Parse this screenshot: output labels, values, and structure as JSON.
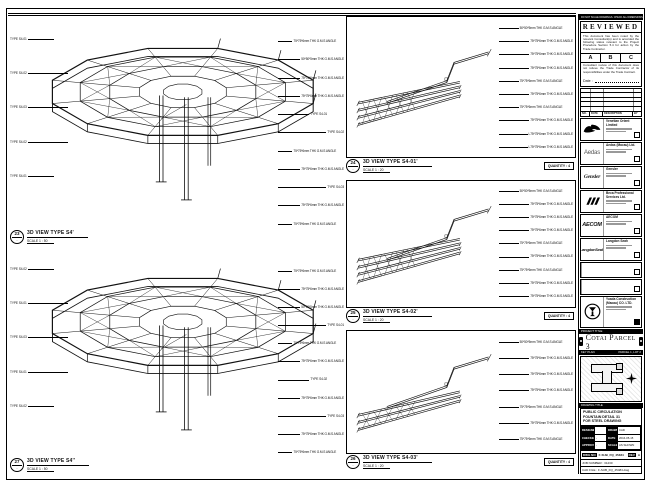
{
  "sheet_note": "DO NOT SCALE DRAWINGS. CHECK ALL DIMENSIONS ON SITE.",
  "reviewed": {
    "title": "REVIEWED",
    "body1": "This document has been noted by the relevant Consultant(s) and is accorded the following status relevant to the Project Procedure Section 5.4 for action by the Trade Contractor.",
    "options": {
      "a": "A",
      "b": "B",
      "c": "C"
    },
    "body2": "Consultant review of this document does not relieve the Trade Contractor of its responsibilities under the Trade Contract.",
    "date_label": "Date :"
  },
  "rev_table": {
    "h1": "NO.",
    "h2": "DATE",
    "h3": "DESCRIPTION",
    "h4": "BY"
  },
  "companies": [
    {
      "wordmark": "",
      "name": "Venetian Orient Limited"
    },
    {
      "wordmark": "Aedas",
      "name": "Aedas (Macau) Ltd."
    },
    {
      "wordmark": "Gensler",
      "name": "Gensler"
    },
    {
      "wordmark": "",
      "name": "Beca Professional Services Ltd."
    },
    {
      "wordmark": "AECOM",
      "name": "AECOM"
    },
    {
      "wordmark": "LangdonSeah",
      "name": "Langdon Seah"
    }
  ],
  "contractor": {
    "name": "Yuada Construction",
    "name2": "(Macau) CO. LTD."
  },
  "project": {
    "label": "PROJECT TITLE",
    "name": "Cotai Parcel 3"
  },
  "keyplan": {
    "label": "KEY PLAN",
    "parcel": "PARCEL 1, LOT 2"
  },
  "drawing": {
    "label": "DRAWING TITLE",
    "line1": "PUBLIC CIRCULATION",
    "line2": "FOUNTAIN DETAIL 31",
    "line3": "FOR STEEL DRAWING",
    "designed_label": "DESIGNED",
    "designed": "",
    "drawn_label": "DRAWN",
    "drawn": "CAD",
    "checked_label": "CHECKED",
    "checked": "-",
    "date_label": "DATE",
    "date": "2016-05-15",
    "approved_label": "APPROVED",
    "approved": "-",
    "scale_label": "SCALE",
    "scale": "AS SHOWN",
    "dwg_label": "DWG NO",
    "dwg_no": "F-SUB_FQ_45484",
    "rev_label": "REV",
    "rev": "A",
    "job_row": "JOB NUMBER : 31230",
    "file_row": "CAD FILE : F-SUB_FQ_45484.dwg"
  },
  "views": {
    "l1": {
      "no": "23",
      "ref": "-",
      "title": "3D VIEW TYPE S4'",
      "scale": "SCALE 1 : 50",
      "labels_left": [
        "TYPE S4-01",
        "TYPE S4-02",
        "TYPE S4-03",
        "TYPE S4-02",
        "TYPE S4-01"
      ],
      "labels_right": [
        "75*75*6mm THK G.M.S ANGLE",
        "50*50*5mm THK G.M.S ANGLE",
        "75*75*6mm THK G.M.S ANGLE",
        "75*75*6mm THK G.M.S ANGLE",
        "TYPE S4-01",
        "TYPE S4-02",
        "75*75*6mm THK G.M.S ANGLE",
        "75*75*6mm THK G.M.S ANGLE",
        "TYPE S4-03",
        "75*75*6mm THK G.M.S ANGLE",
        "75*75*6mm THK G.M.S ANGLE"
      ]
    },
    "l2": {
      "no": "27",
      "ref": "-",
      "title": "3D VIEW TYPE S4''",
      "scale": "SCALE 1 : 50",
      "labels_left": [
        "TYPE S4-02",
        "TYPE S4-01",
        "TYPE S4-03",
        "TYPE S4-01",
        "TYPE S4-02"
      ],
      "labels_right": [
        "75*75*6mm THK G.M.S ANGLE",
        "75*75*6mm THK G.M.S ANGLE",
        "50*50*5mm THK G.M.S ANGLE",
        "TYPE S4-01",
        "75*75*6mm THK G.M.S ANGLE",
        "75*75*6mm THK G.M.S ANGLE",
        "TYPE S4-02",
        "75*75*6mm THK G.M.S ANGLE",
        "TYPE S4-03",
        "75*75*6mm THK G.M.S ANGLE",
        "75*75*6mm THK G.M.S ANGLE"
      ]
    },
    "p1": {
      "no": "24",
      "ref": "-",
      "title": "3D VIEW TYPE S4-01'",
      "scale": "SCALE 1 : 20",
      "quantity": "QUANTITY : 4",
      "labels": [
        "50*50*5mm THK G.M.S ANGLE",
        "75*75*6mm THK G.M.S ANGLE",
        "75*75*6mm THK G.M.S ANGLE",
        "75*75*6mm THK G.M.S ANGLE",
        "75*75*6mm THK G.M.S ANGLE",
        "75*75*6mm THK G.M.S ANGLE",
        "75*75*6mm THK G.M.S ANGLE",
        "75*75*6mm THK G.M.S ANGLE",
        "L75*75*6mm THK G.M.S ANGLE",
        "L75*75*6mm THK G.M.S ANGLE"
      ]
    },
    "p2": {
      "no": "25",
      "ref": "-",
      "title": "3D VIEW TYPE S4-02'",
      "scale": "SCALE 1 : 20",
      "quantity": "QUANTITY : 4",
      "labels": [
        "50*50*5mm THK G.M.S ANGLE",
        "75*75*6mm THK G.M.S ANGLE",
        "75*75*6mm THK G.M.S ANGLE",
        "75*75*6mm THK G.M.S ANGLE",
        "75*75*6mm THK G.M.S ANGLE",
        "75*75*6mm THK G.M.S ANGLE",
        "75*75*6mm THK G.M.S ANGLE",
        "75*75*6mm THK G.M.S ANGLE",
        "75*75*6mm THK G.M.S ANGLE"
      ]
    },
    "p3": {
      "no": "26",
      "ref": "-",
      "title": "3D VIEW TYPE S4-03'",
      "scale": "SCALE 1 : 20",
      "quantity": "QUANTITY : 4",
      "labels": [
        "50*50*5mm THK G.M.S ANGLE",
        "75*75*6mm THK G.M.S ANGLE",
        "75*75*6mm THK G.M.S ANGLE",
        "75*75*6mm THK G.M.S ANGLE",
        "75*75*6mm THK G.M.S ANGLE",
        "75*75*6mm THK G.M.S ANGLE",
        "75*75*6mm THK G.M.S ANGLE"
      ]
    }
  }
}
